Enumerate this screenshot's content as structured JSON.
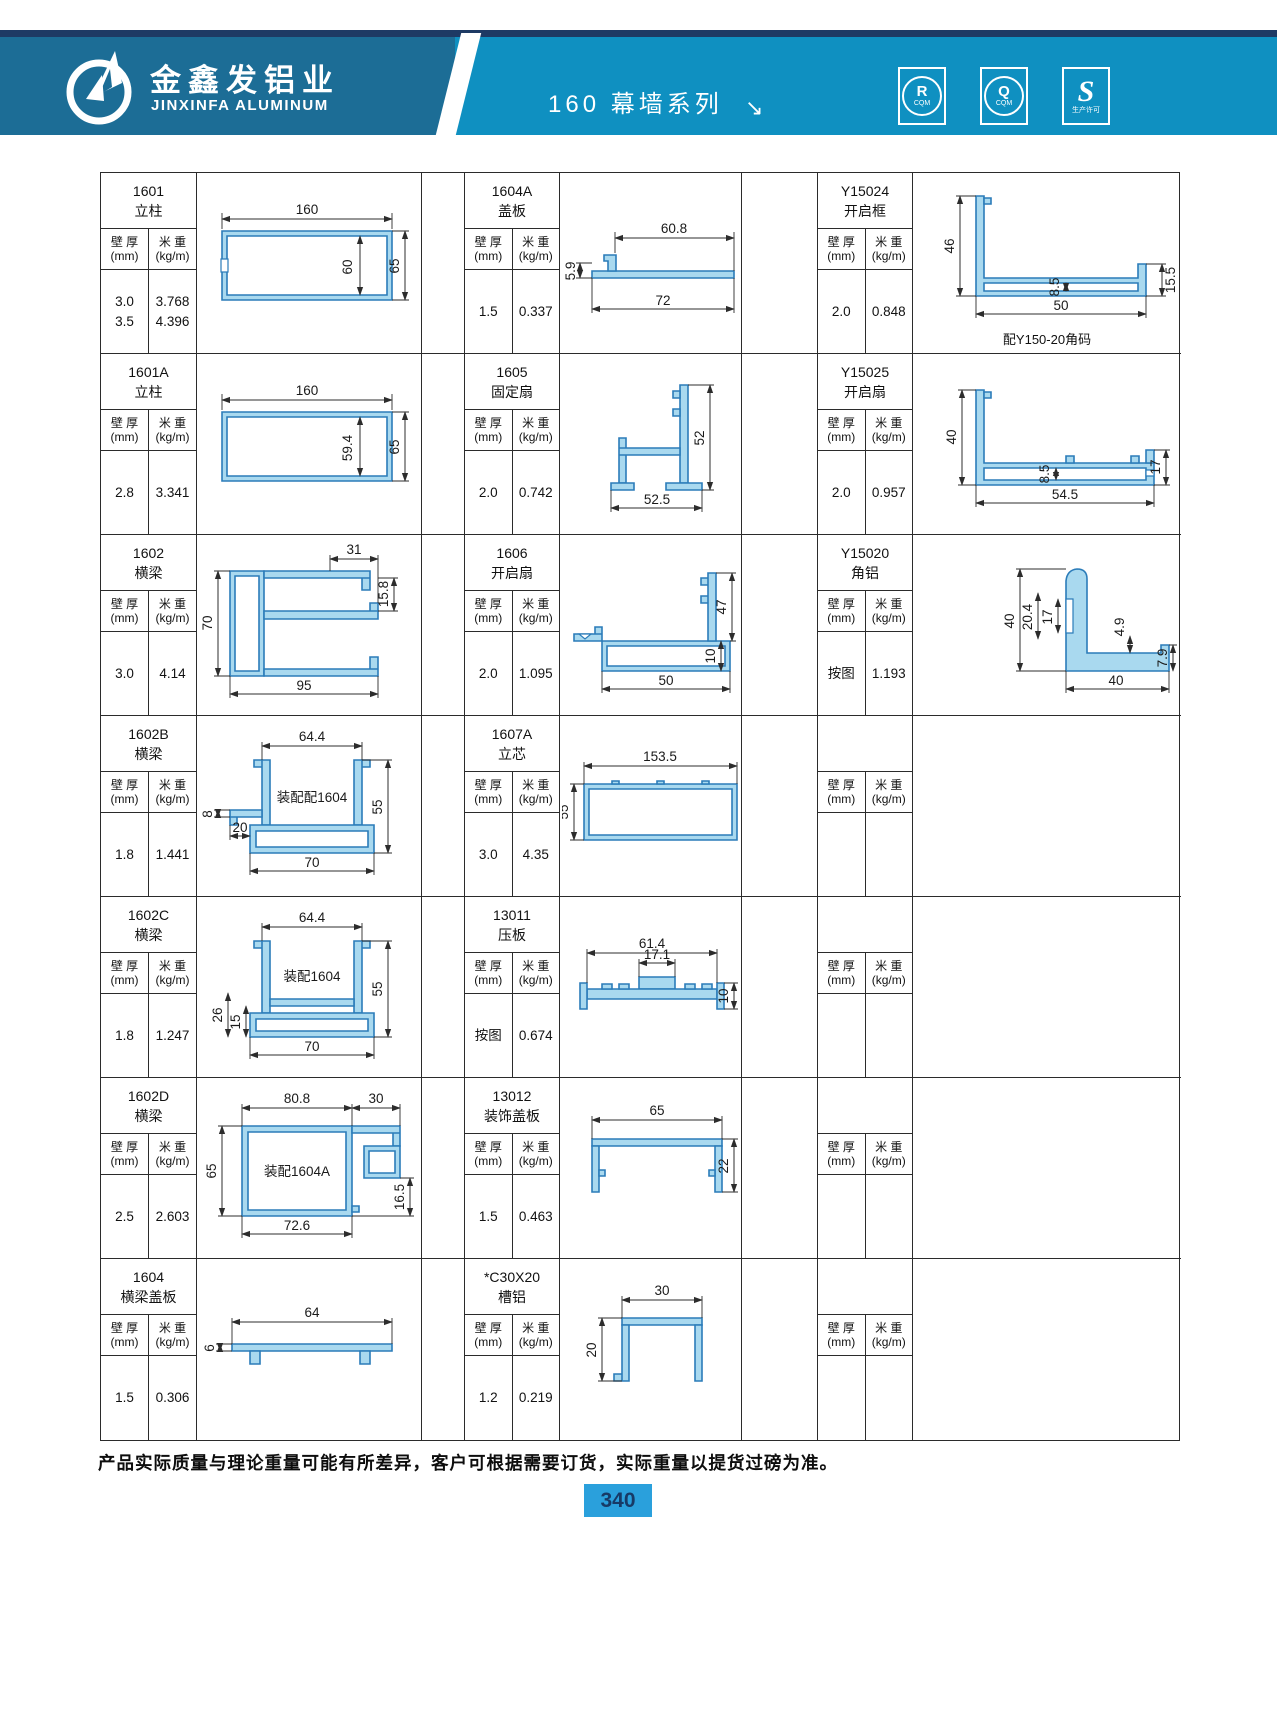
{
  "header": {
    "company_cn": "金鑫发铝业",
    "company_en": "JINXINFA ALUMINUM",
    "series_title": "160 幕墙系列",
    "arrow": "↘",
    "badges": [
      {
        "sym": "R",
        "sub": "CQM"
      },
      {
        "sym": "Q",
        "sub": "CQM"
      },
      {
        "sym": "S",
        "sub": "生产许可"
      }
    ],
    "colors": {
      "band_left": "#1c6d96",
      "band_right": "#0f90c1",
      "top_strip": "#1e3a64",
      "profile_fill": "#a9d9ef",
      "page_badge": "#2aa0dc"
    }
  },
  "table": {
    "labels": {
      "t1": "壁 厚",
      "t2": "(mm)",
      "w1": "米 重",
      "w2": "(kg/m)"
    },
    "rows": [
      {
        "cells": [
          {
            "code": "1601",
            "name": "立柱",
            "th1": "3.0",
            "th2": "3.5",
            "wt1": "3.768",
            "wt2": "4.396",
            "label": "",
            "note": "",
            "d": {
              "a": "160",
              "b": "60",
              "c": "65"
            }
          },
          {
            "code": "1604A",
            "name": "盖板",
            "th1": "1.5",
            "th2": "",
            "wt1": "0.337",
            "wt2": "",
            "label": "",
            "note": "",
            "d": {
              "a": "60.8",
              "b": "72",
              "c": "5.9"
            }
          },
          {
            "code": "Y15024",
            "name": "开启框",
            "th1": "2.0",
            "th2": "",
            "wt1": "0.848",
            "wt2": "",
            "label": "",
            "note": "配Y150-20角码",
            "d": {
              "a": "46",
              "b": "8.5",
              "c": "15.5",
              "e": "50"
            }
          }
        ]
      },
      {
        "cells": [
          {
            "code": "1601A",
            "name": "立柱",
            "th1": "2.8",
            "th2": "",
            "wt1": "3.341",
            "wt2": "",
            "label": "",
            "note": "",
            "d": {
              "a": "160",
              "b": "59.4",
              "c": "65"
            }
          },
          {
            "code": "1605",
            "name": "固定扇",
            "th1": "2.0",
            "th2": "",
            "wt1": "0.742",
            "wt2": "",
            "label": "",
            "note": "",
            "d": {
              "a": "52",
              "b": "52.5"
            }
          },
          {
            "code": "Y15025",
            "name": "开启扇",
            "th1": "2.0",
            "th2": "",
            "wt1": "0.957",
            "wt2": "",
            "label": "",
            "note": "",
            "d": {
              "a": "40",
              "b": "8.5",
              "c": "17",
              "e": "54.5"
            }
          }
        ]
      },
      {
        "cells": [
          {
            "code": "1602",
            "name": "横梁",
            "th1": "3.0",
            "th2": "",
            "wt1": "4.14",
            "wt2": "",
            "label": "",
            "note": "",
            "d": {
              "a": "31",
              "b": "15.8",
              "c": "70",
              "e": "95"
            }
          },
          {
            "code": "1606",
            "name": "开启扇",
            "th1": "2.0",
            "th2": "",
            "wt1": "1.095",
            "wt2": "",
            "label": "",
            "note": "",
            "d": {
              "a": "47",
              "b": "10",
              "c": "50"
            }
          },
          {
            "code": "Y15020",
            "name": "角铝",
            "th1": "按图",
            "th2": "",
            "wt1": "1.193",
            "wt2": "",
            "label": "",
            "note": "",
            "d": {
              "a": "40",
              "b": "20.4",
              "c": "17",
              "e": "4.9",
              "f": "7.9",
              "g": "40"
            }
          }
        ]
      },
      {
        "cells": [
          {
            "code": "1602B",
            "name": "横梁",
            "th1": "1.8",
            "th2": "",
            "wt1": "1.441",
            "wt2": "",
            "label": "装配配1604",
            "note": "",
            "d": {
              "a": "64.4",
              "b": "8",
              "c": "20",
              "e": "55",
              "f": "70"
            }
          },
          {
            "code": "1607A",
            "name": "立芯",
            "th1": "3.0",
            "th2": "",
            "wt1": "4.35",
            "wt2": "",
            "label": "",
            "note": "",
            "d": {
              "a": "153.5",
              "b": "55"
            }
          },
          {
            "code": "",
            "name": "",
            "th1": "",
            "th2": "",
            "wt1": "",
            "wt2": "",
            "label": "",
            "note": "",
            "d": {}
          }
        ]
      },
      {
        "cells": [
          {
            "code": "1602C",
            "name": "横梁",
            "th1": "1.8",
            "th2": "",
            "wt1": "1.247",
            "wt2": "",
            "label": "装配1604",
            "note": "",
            "d": {
              "a": "64.4",
              "b": "26",
              "c": "15",
              "e": "55",
              "f": "70"
            }
          },
          {
            "code": "13011",
            "name": "压板",
            "th1": "按图",
            "th2": "",
            "wt1": "0.674",
            "wt2": "",
            "label": "",
            "note": "",
            "d": {
              "a": "61.4",
              "b": "17.1",
              "c": "10"
            }
          },
          {
            "code": "",
            "name": "",
            "th1": "",
            "th2": "",
            "wt1": "",
            "wt2": "",
            "label": "",
            "note": "",
            "d": {}
          }
        ]
      },
      {
        "cells": [
          {
            "code": "1602D",
            "name": "横梁",
            "th1": "2.5",
            "th2": "",
            "wt1": "2.603",
            "wt2": "",
            "label": "装配1604A",
            "note": "",
            "d": {
              "a": "80.8",
              "b": "30",
              "c": "65",
              "e": "16.5",
              "f": "72.6"
            }
          },
          {
            "code": "13012",
            "name": "装饰盖板",
            "th1": "1.5",
            "th2": "",
            "wt1": "0.463",
            "wt2": "",
            "label": "",
            "note": "",
            "d": {
              "a": "65",
              "b": "22"
            }
          },
          {
            "code": "",
            "name": "",
            "th1": "",
            "th2": "",
            "wt1": "",
            "wt2": "",
            "label": "",
            "note": "",
            "d": {}
          }
        ]
      },
      {
        "cells": [
          {
            "code": "1604",
            "name": "横梁盖板",
            "th1": "1.5",
            "th2": "",
            "wt1": "0.306",
            "wt2": "",
            "label": "",
            "note": "",
            "d": {
              "a": "64",
              "b": "6"
            }
          },
          {
            "code": "*C30X20",
            "name": "槽铝",
            "th1": "1.2",
            "th2": "",
            "wt1": "0.219",
            "wt2": "",
            "label": "",
            "note": "",
            "d": {
              "a": "30",
              "b": "20"
            }
          },
          {
            "code": "",
            "name": "",
            "th1": "",
            "th2": "",
            "wt1": "",
            "wt2": "",
            "label": "",
            "note": "",
            "d": {}
          }
        ]
      }
    ]
  },
  "footer": {
    "note": "产品实际质量与理论重量可能有所差异，客户可根据需要订货，实际重量以提货过磅为准。",
    "page": "340"
  }
}
